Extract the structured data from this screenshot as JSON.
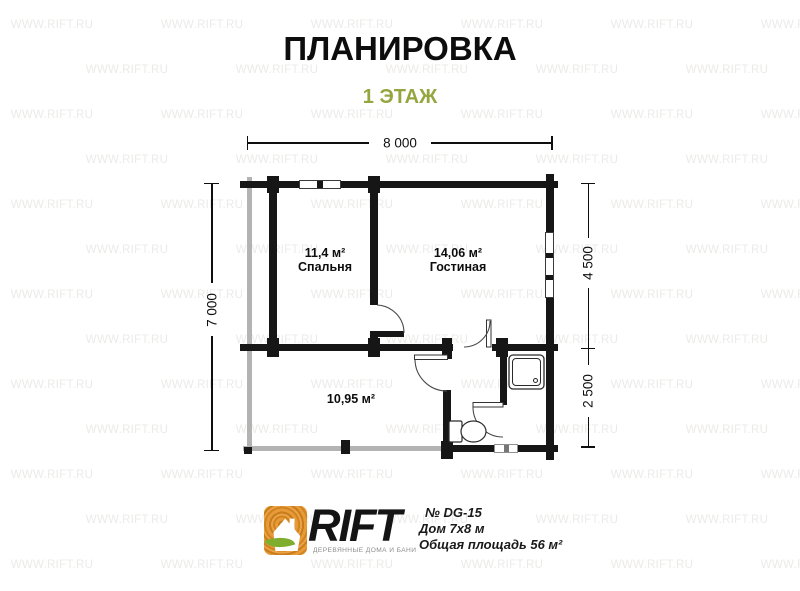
{
  "header": {
    "title": "ПЛАНИРОВКА",
    "subtitle": "1 ЭТАЖ"
  },
  "watermark": {
    "text": "WWW.RIFT.RU"
  },
  "plan": {
    "rooms": {
      "bedroom": {
        "area": "11,4 м²",
        "name": "Спальня"
      },
      "living": {
        "area": "14,06 м²",
        "name": "Гостиная"
      },
      "terrace": {
        "area": "10,95 м²"
      }
    },
    "dimensions": {
      "width_total": "8 000",
      "height_total": "7 000",
      "depth_upper": "4 500",
      "depth_lower": "2 500"
    }
  },
  "footer": {
    "brand": "RIFT",
    "tagline": "ДЕРЕВЯННЫЕ ДОМА И БАНИ",
    "project_no": "№ DG-15",
    "house_size": "Дом 7х8 м",
    "total_area": "Общая площадь 56 м²"
  },
  "colors": {
    "subtitle_green": "#95a640",
    "wall": "#161616",
    "terrace_gray": "#b3b3b3",
    "logo_orange": "#e2921e",
    "leaf_green": "#7fae2f"
  }
}
